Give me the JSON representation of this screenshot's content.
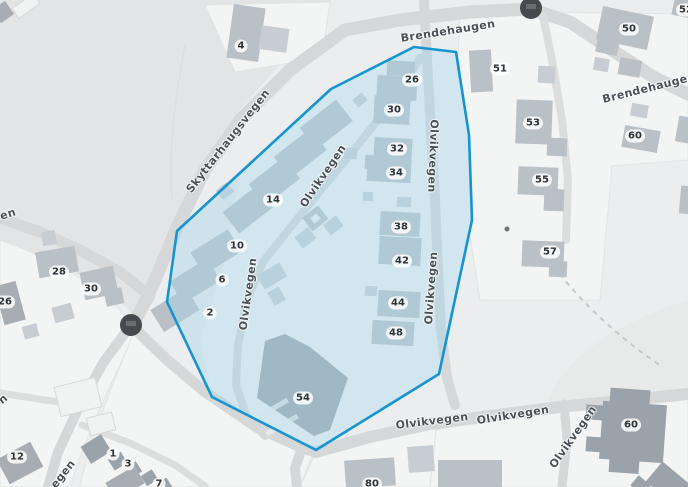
{
  "map": {
    "background_color": "#ecedee",
    "road_color": "#d6d7d8",
    "parcel_color": "#f3f4f4",
    "terrain_color": "#e3e4e5",
    "building_color": "#b9c0c6",
    "building_dark_color": "#9ba3aa",
    "selection": {
      "fill_color": "#a5d6ea",
      "fill_opacity": 0.42,
      "stroke_color": "#1694d1",
      "stroke_width": 2.6,
      "vertices": [
        [
          414,
          47
        ],
        [
          456,
          52
        ],
        [
          469,
          135
        ],
        [
          472,
          220
        ],
        [
          439,
          374
        ],
        [
          316,
          450
        ],
        [
          212,
          397
        ],
        [
          167,
          302
        ],
        [
          177,
          231
        ],
        [
          331,
          89
        ]
      ]
    },
    "street_labels": [
      {
        "text": "Brendehaugen",
        "x": 448,
        "y": 31,
        "rot": -9
      },
      {
        "text": "Brendehaugen",
        "x": 649,
        "y": 88,
        "rot": -14
      },
      {
        "text": "Skyttarhaugsvegen",
        "x": 228,
        "y": 141,
        "rot": -52
      },
      {
        "text": "Olvikvegen",
        "x": 323,
        "y": 176,
        "rot": -56
      },
      {
        "text": "Olvikvegen",
        "x": 433,
        "y": 156,
        "rot": 92
      },
      {
        "text": "Olvikvegen",
        "x": 248,
        "y": 294,
        "rot": -82
      },
      {
        "text": "Olvikvegen",
        "x": 431,
        "y": 288,
        "rot": -86
      },
      {
        "text": "Olvikvegen",
        "x": 432,
        "y": 421,
        "rot": -7
      },
      {
        "text": "Olvikvegen",
        "x": 513,
        "y": 415,
        "rot": -9
      },
      {
        "text": "Olvikvegen",
        "x": 573,
        "y": 437,
        "rot": -55
      },
      {
        "text": "en",
        "x": 8,
        "y": 214,
        "rot": -18
      },
      {
        "text": "n",
        "x": 3,
        "y": 399,
        "rot": -40
      },
      {
        "text": "egen",
        "x": 63,
        "y": 474,
        "rot": -52
      }
    ],
    "house_numbers": [
      {
        "text": "4",
        "x": 241,
        "y": 46
      },
      {
        "text": "26",
        "x": 412,
        "y": 80
      },
      {
        "text": "30",
        "x": 394,
        "y": 110
      },
      {
        "text": "32",
        "x": 397,
        "y": 149
      },
      {
        "text": "34",
        "x": 396,
        "y": 173
      },
      {
        "text": "38",
        "x": 401,
        "y": 227
      },
      {
        "text": "42",
        "x": 402,
        "y": 261
      },
      {
        "text": "44",
        "x": 398,
        "y": 303
      },
      {
        "text": "48",
        "x": 396,
        "y": 333
      },
      {
        "text": "14",
        "x": 273,
        "y": 200
      },
      {
        "text": "10",
        "x": 237,
        "y": 246
      },
      {
        "text": "6",
        "x": 222,
        "y": 280
      },
      {
        "text": "2",
        "x": 210,
        "y": 313
      },
      {
        "text": "54",
        "x": 303,
        "y": 398
      },
      {
        "text": "51",
        "x": 500,
        "y": 69
      },
      {
        "text": "53",
        "x": 533,
        "y": 123
      },
      {
        "text": "55",
        "x": 542,
        "y": 180
      },
      {
        "text": "57",
        "x": 550,
        "y": 252
      },
      {
        "text": "50",
        "x": 629,
        "y": 29
      },
      {
        "text": "52",
        "x": 686,
        "y": 10
      },
      {
        "text": "60",
        "x": 635,
        "y": 136
      },
      {
        "text": "60",
        "x": 631,
        "y": 425
      },
      {
        "text": "28",
        "x": 59,
        "y": 272
      },
      {
        "text": "30",
        "x": 91,
        "y": 289
      },
      {
        "text": "26",
        "x": 5,
        "y": 302
      },
      {
        "text": "12",
        "x": 17,
        "y": 457
      },
      {
        "text": "1",
        "x": 113,
        "y": 454
      },
      {
        "text": "3",
        "x": 128,
        "y": 464
      },
      {
        "text": "7",
        "x": 159,
        "y": 484
      },
      {
        "text": "80",
        "x": 372,
        "y": 484
      }
    ],
    "markers": [
      {
        "name": "junction-marker",
        "x": 531,
        "y": 8,
        "r": 11
      },
      {
        "name": "junction-marker",
        "x": 131,
        "y": 325,
        "r": 11
      },
      {
        "name": "small-dot-marker",
        "x": 507,
        "y": 229,
        "r": 2.5
      }
    ]
  }
}
